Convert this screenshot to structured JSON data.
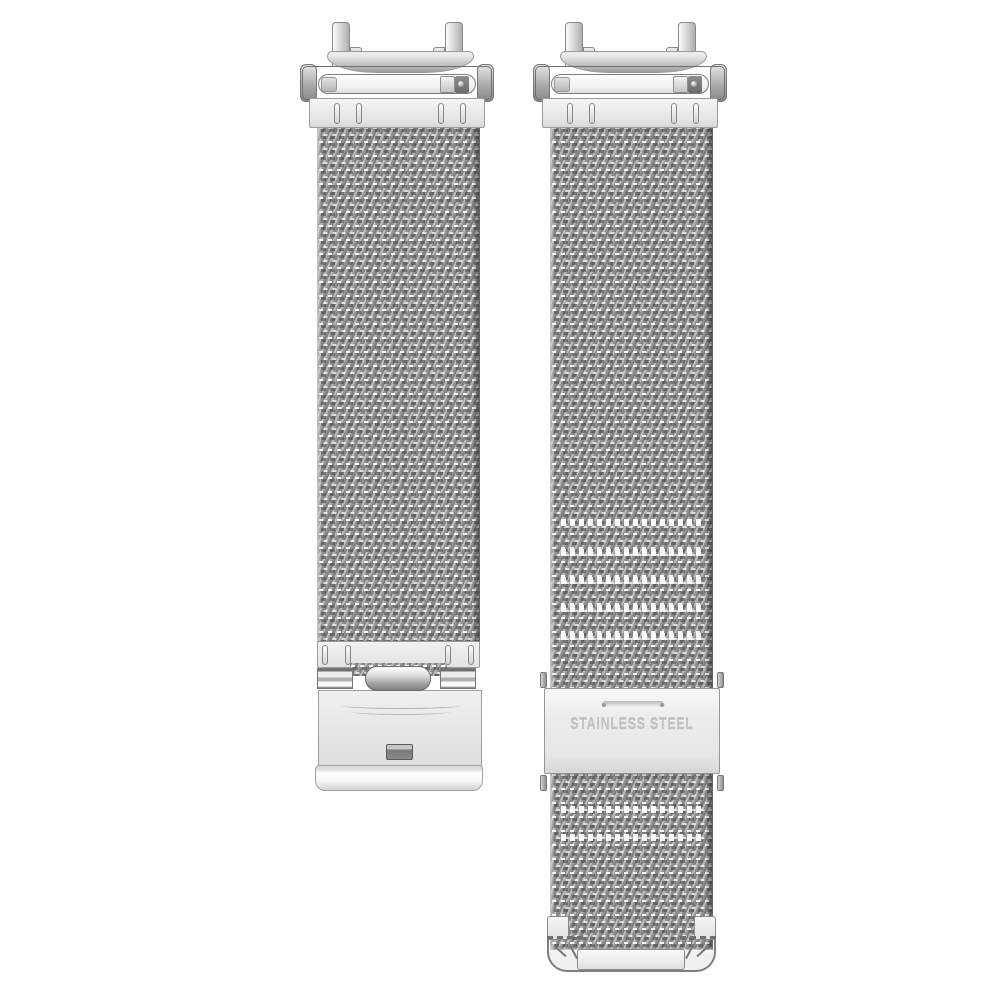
{
  "scene": {
    "type": "product-photo",
    "subject": "Silver stainless steel milanese mesh watch band set with quick-release lug adapters, fold-over buckle strap and slide-clasp strap",
    "background_color": "#ffffff"
  },
  "slide_clasp": {
    "engraving": "STAINLESS STEEL"
  },
  "colors": {
    "mesh_base": "#a0a0a2",
    "mesh_highlight": "#ffffff",
    "mesh_shadow": "#646466",
    "plate_light": "#f2f2f4",
    "plate_border": "#98989a",
    "engraving_text": "#c2c2c4"
  }
}
